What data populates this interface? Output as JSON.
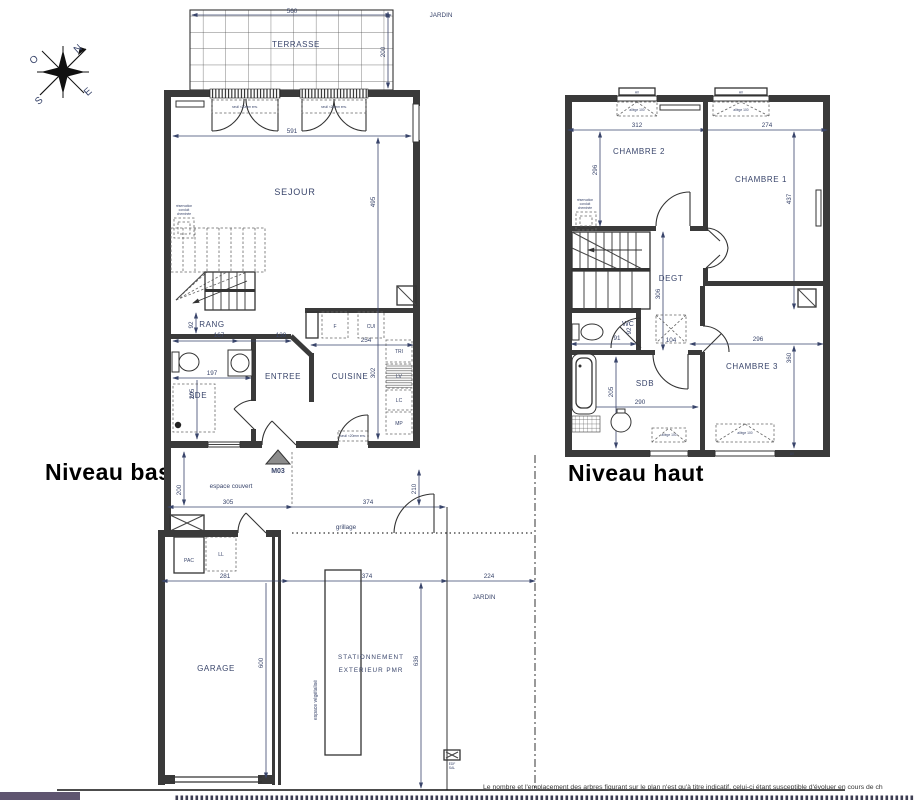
{
  "titles": {
    "low": "Niveau bas",
    "high": "Niveau haut"
  },
  "compass": {
    "n": "N",
    "e": "E",
    "s": "S",
    "o": "O"
  },
  "outdoor": {
    "jardin_top": "JARDIN",
    "jardin_mid": "JARDIN",
    "terrasse": "TERRASSE",
    "espace_couvert": "espace couvert",
    "grillage": "grillage",
    "espace_vegetalise": "espace végétalisé",
    "garage": "GARAGE",
    "stationnement_1": "STATIONNEMENT",
    "stationnement_2": "EXTERIEUR PMR",
    "marker": "M03",
    "pac": "PAC",
    "ll": "LL",
    "edf_1": "EDF",
    "edf_2": "SAL"
  },
  "low": {
    "rooms": {
      "sejour": "SEJOUR",
      "rang": "RANG",
      "sde": "SDE",
      "entree": "ENTREE",
      "cuisine": "CUISINE"
    },
    "fixtures": {
      "f": "F",
      "cui": "CUI",
      "tri": "TRI",
      "lv": "LV",
      "lc": "LC",
      "mp": "MP"
    },
    "notes": {
      "reservation_1": "réservation",
      "reservation_2": "conduit",
      "reservation_3": "cheminée",
      "seuil": "seuil <20mm env."
    },
    "dims": {
      "terrasse_w": "560",
      "terrasse_d": "200",
      "sejour_w": "591",
      "sejour_d": "495",
      "rang_d": "92",
      "rang_w": "167",
      "entree_w": "130",
      "cuisine_w": "254",
      "sde_w": "197",
      "sde_d": "205",
      "cuisine_d": "302",
      "couvert_d": "200",
      "couvert_w": "305",
      "cour_w": "374",
      "portail": "210",
      "garage_w": "281",
      "garage_d": "600",
      "parking_w": "374",
      "jardin_w": "224",
      "parking_d": "636"
    }
  },
  "high": {
    "rooms": {
      "ch1": "CHAMBRE 1",
      "ch2": "CHAMBRE 2",
      "ch3": "CHAMBRE 3",
      "degt": "DEGT",
      "wc": "WC",
      "sdb": "SDB"
    },
    "notes": {
      "av": "AV",
      "allege": "allège 100",
      "reservation_1": "réservation",
      "reservation_2": "conduit",
      "reservation_3": "cheminée"
    },
    "dims": {
      "ch2_w": "312",
      "ch1_w": "274",
      "ch2_d": "296",
      "ch1_d": "437",
      "degt_d": "306",
      "wc_w": "91",
      "wc_d": "92",
      "tremie": "104",
      "ch3_w": "296",
      "sdb_d": "205",
      "sdb_w": "290",
      "ch3_d": "360"
    }
  },
  "footer": {
    "disclaimer": "Le nombre et l'emplacement des arbres figurant sur le plan n'est qu'à titre indicatif, celui-ci étant susceptible d'évoluer en cours de ch"
  }
}
